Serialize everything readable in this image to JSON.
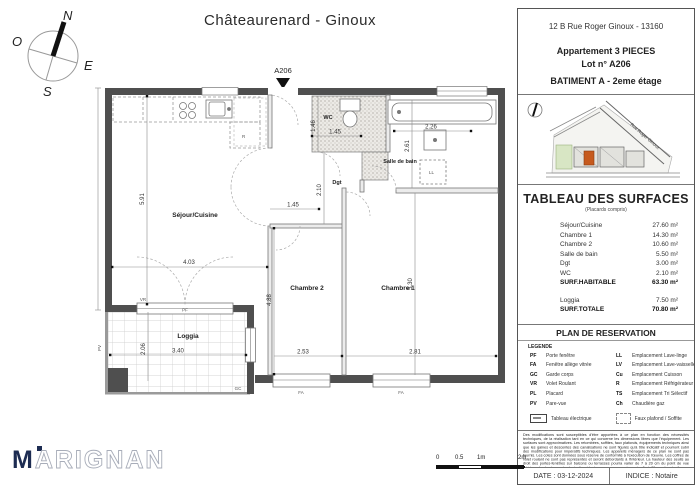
{
  "header": {
    "title": "Châteaurenard - Ginoux"
  },
  "compass": {
    "n": "N",
    "o": "O",
    "e": "E",
    "s": "S"
  },
  "info": {
    "address": "12 B Rue Roger Ginoux - 13160",
    "apartment": "Appartement 3 PIECES",
    "lot": "Lot n° A206",
    "building": "BATIMENT A  -  2eme étage"
  },
  "site_map": {
    "road": "Rue Roger Ginoux"
  },
  "surfaces": {
    "title": "TABLEAU DES SURFACES",
    "subtitle": "(Placards compris)",
    "rows": [
      {
        "label": "Séjour/Cuisine",
        "value": "27.60 m²"
      },
      {
        "label": "Chambre 1",
        "value": "14.30 m²"
      },
      {
        "label": "Chambre 2",
        "value": "10.60 m²"
      },
      {
        "label": "Salle de bain",
        "value": "5.50 m²"
      },
      {
        "label": "Dgt",
        "value": "3.00 m²"
      },
      {
        "label": "WC",
        "value": "2.10 m²"
      }
    ],
    "habitable_label": "SURF.HABITABLE",
    "habitable_value": "63.30 m²",
    "loggia_label": "Loggia",
    "loggia_value": "7.50 m²",
    "total_label": "SURF.TOTALE",
    "total_value": "70.80 m²"
  },
  "reservation": {
    "title": "PLAN DE RESERVATION",
    "legend_label": "LEGENDE",
    "left": [
      {
        "abbr": "PF",
        "label": "Porte fenêtre"
      },
      {
        "abbr": "FA",
        "label": "Fenêtre allège vitrée"
      },
      {
        "abbr": "GC",
        "label": "Garde corps"
      },
      {
        "abbr": "VR",
        "label": "Volet Roulant"
      },
      {
        "abbr": "PL",
        "label": "Placard"
      },
      {
        "abbr": "PV",
        "label": "Pare-vue"
      }
    ],
    "right": [
      {
        "abbr": "LL",
        "label": "Emplacement Lave-linge"
      },
      {
        "abbr": "LV",
        "label": "Emplacement Lave-vaisselle"
      },
      {
        "abbr": "Cu",
        "label": "Emplacement Cuisson"
      },
      {
        "abbr": "R",
        "label": "Emplacement Réfrigérateur"
      },
      {
        "abbr": "TS",
        "label": "Emplacement Tri Sélectif"
      },
      {
        "abbr": "Ch",
        "label": "Chaudière gaz"
      }
    ],
    "tableau_label": "Tableau électrique",
    "faux_label": "Faux plafond / Soffite"
  },
  "disclaimer": "Des modifications sont susceptibles d'être apportées à ce plan en fonction des nécessités techniques, de la réalisation tant en ce qui concerne les dimensions libres que l'équipement. Les surfaces sont approximatives. Les retombées, soffites, faux plafonds, équipements techniques ainsi que les gaines et descentes des canalisations ne sont figurés qu'à titre indicatif et pourront subir des modifications pour impératifs techniques. Les appareils ménagers de ce plan ne sont pas fournis. Les cotes sont données sous réserve de conformité à l'exécution de l'œuvre. Les coffres de volet roulant ne sont pas représentés et seront débordants à l'intérieur. La hauteur des seuils au droit des portes-fenêtres sur balcons ou terrasses pourra varier de 7 à 20 cm du point de vue intérieur. La hauteur entre le jardin et la terrasse pourra varier entre 0 et 80 cm. Les jardins ne seront pas nécessairement plats et pourront s'adapter aux niveaux des parcelles.",
  "footer": {
    "date": "DATE : 03-12-2024",
    "indice": "INDICE : Notaire"
  },
  "logo": {
    "m": "M",
    "rest": "ARIGNAN"
  },
  "scalebar": {
    "l0": "0",
    "l05": "0.5",
    "l1": "1m",
    "l2": "2m"
  },
  "plan": {
    "unit": "A206",
    "rooms": {
      "sejour": "Séjour/Cuisine",
      "chambre1": "Chambre 1",
      "chambre2": "Chambre 2",
      "sdb": "Salle de bain",
      "wc": "WC",
      "dgt": "Dgt",
      "loggia": "Loggia"
    },
    "dims": {
      "sejour_h": "5.91",
      "sejour_w": "4.03",
      "ch2_h": "4.88",
      "wc_h": "1.46",
      "wc_w": "1.45",
      "sdb_w": "2.26",
      "sdb_h": "2.61",
      "dgt_h": "2.10",
      "dgt_w": "1.45",
      "ch2_w": "2.53",
      "ch1_w": "2.81",
      "ch1_h": "5.30",
      "loggia_h": "2.06",
      "loggia_w": "3.40"
    },
    "tags": {
      "pf": "PF",
      "vr": "VR",
      "fa": "FA",
      "gc": "GC",
      "pv": "PV",
      "ll": "LL",
      "r": "R"
    }
  }
}
